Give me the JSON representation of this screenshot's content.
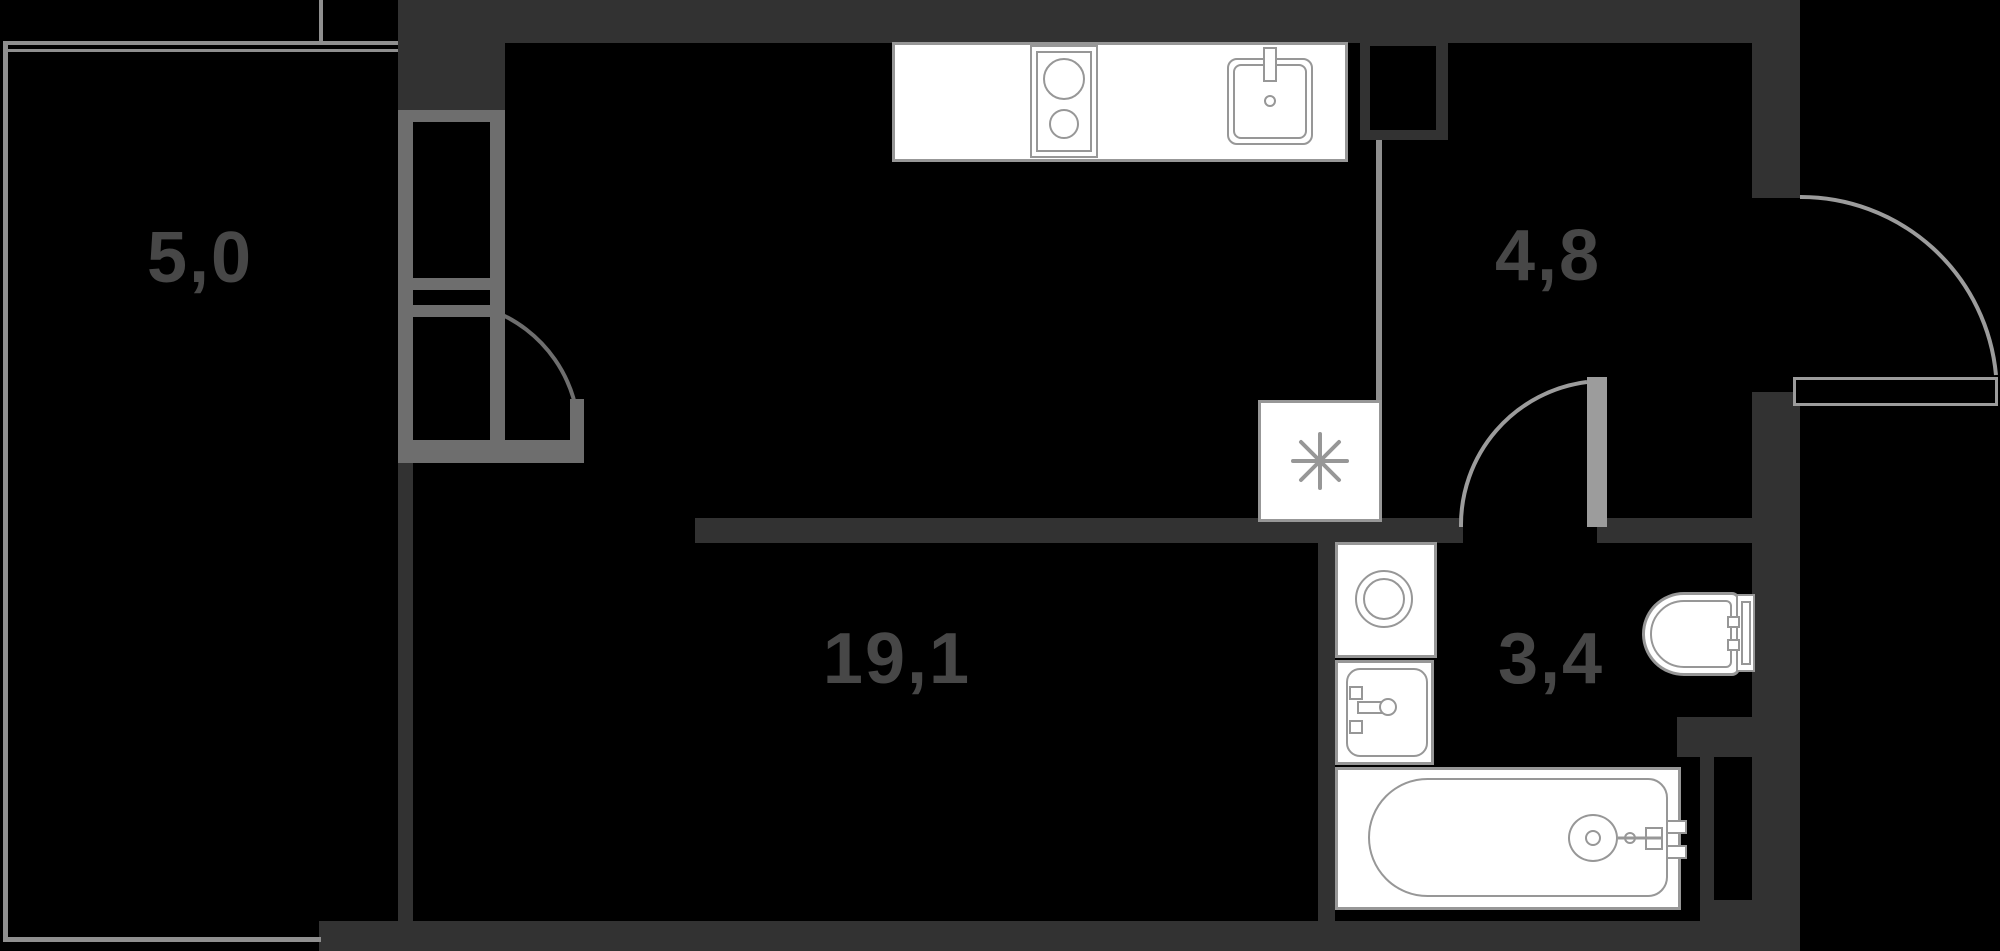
{
  "page": {
    "title": "Studio apartment floor plan"
  },
  "colors": {
    "bg": "#000000",
    "wall": "#323232",
    "glaze": "#8f8f8f",
    "frame": "#6e6e6e",
    "arc": "#9c9c9c",
    "fix": "#979797",
    "fill": "#ffffff",
    "label": "#474747"
  },
  "rooms": [
    {
      "id": "balcony",
      "area_label": "5,0"
    },
    {
      "id": "living-room",
      "area_label": "19,1"
    },
    {
      "id": "hallway",
      "area_label": "4,8"
    },
    {
      "id": "bathroom",
      "area_label": "3,4"
    }
  ],
  "fixtures": {
    "kitchen": [
      "countertop",
      "cooktop",
      "kitchen-sink",
      "refrigerator-niche"
    ],
    "bathroom": [
      "washing-machine",
      "wash-basin",
      "bathtub",
      "toilet"
    ],
    "refrigerator_niche_symbol": "*"
  },
  "doors": [
    "balcony-door",
    "bathroom-door",
    "entry-door"
  ]
}
